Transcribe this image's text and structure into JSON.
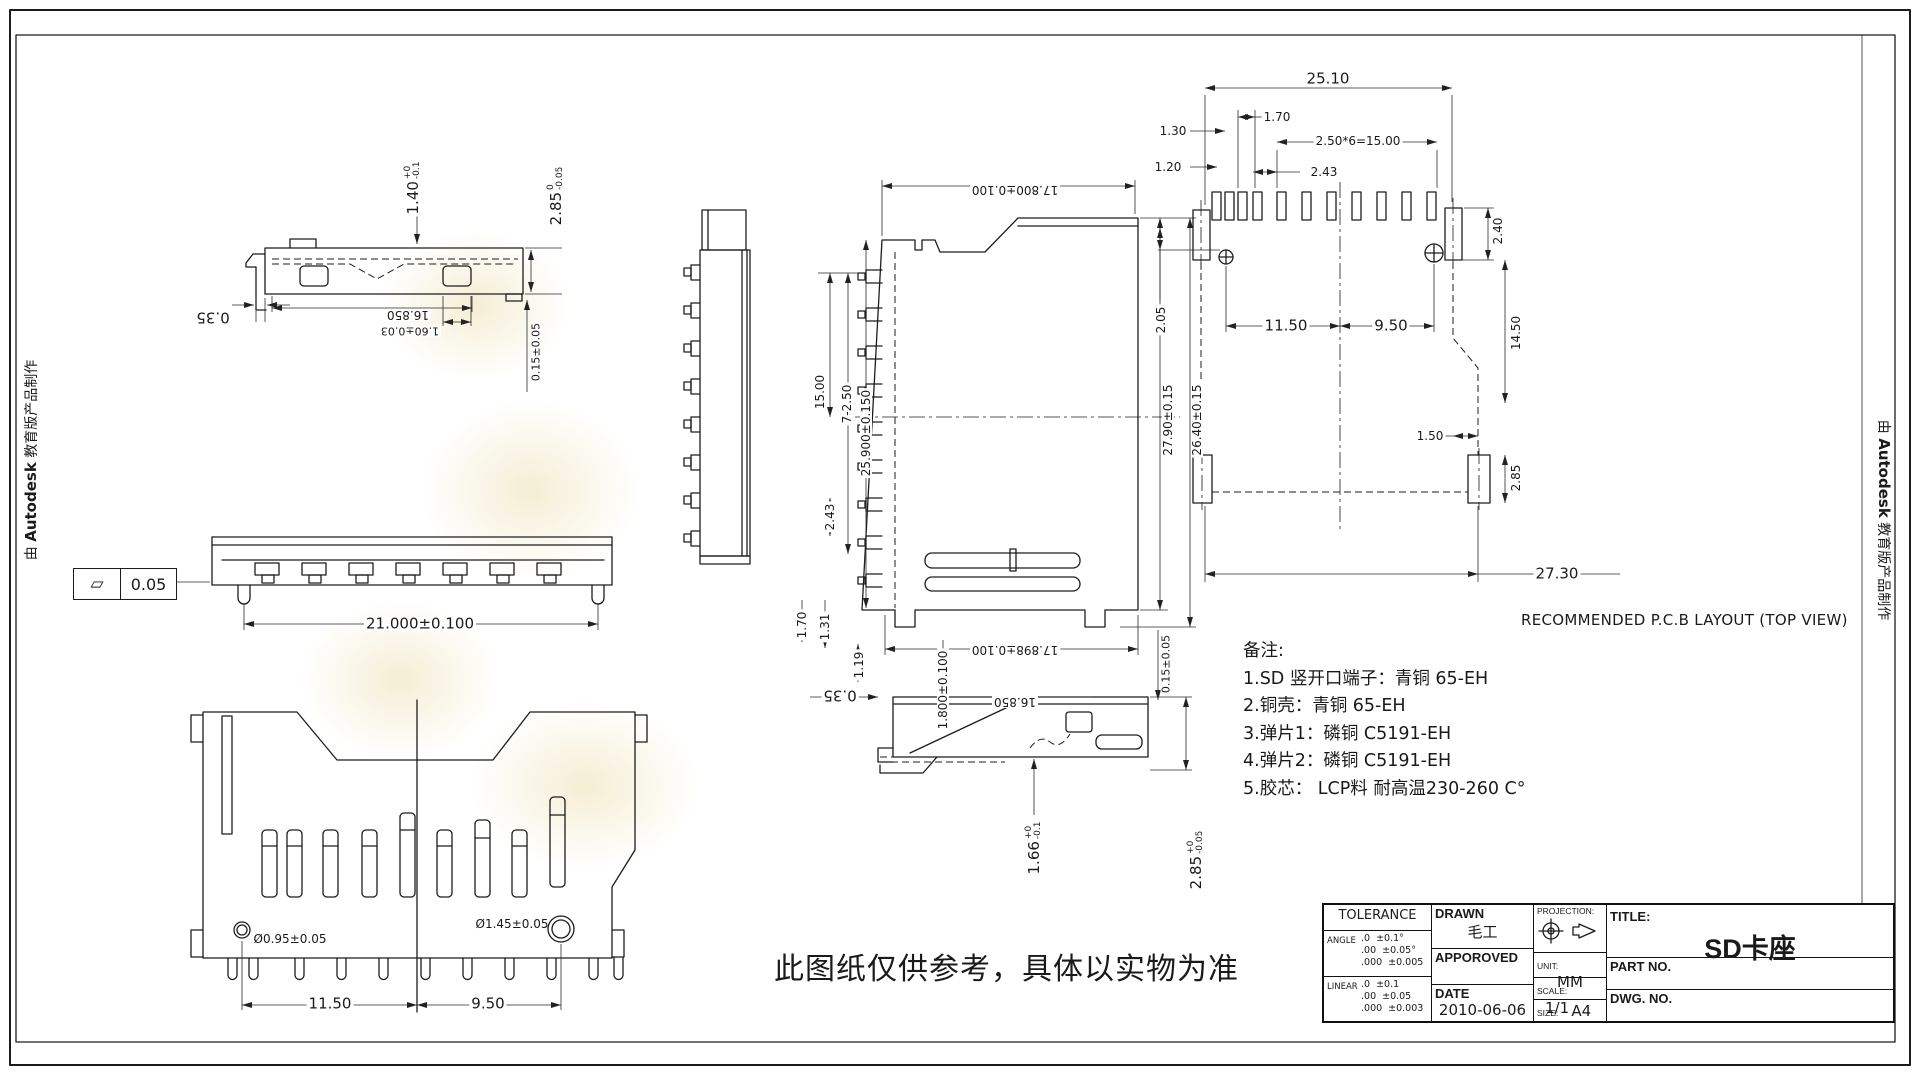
{
  "sheet": {
    "edge_note": {
      "prefix": "由",
      "brand": "Autodesk",
      "suffix": "教育版产品制作"
    },
    "disclaimer": "此图纸仅供参考，具体以实物为准"
  },
  "views": {
    "side_top": {
      "d140": {
        "m": "1.40",
        "u": "+0",
        "d": "-0.1"
      },
      "d285": {
        "m": "2.85",
        "u": "0",
        "d": "-0.05"
      },
      "d035": "0.35",
      "d16850": "16.850",
      "d160": "1.60±0.03",
      "d015": "0.15±0.05"
    },
    "front": {
      "flatness": "0.05",
      "d21000": "21.000±0.100"
    },
    "plan": {
      "hole_small": "Ø0.95±0.05",
      "hole_big": "Ø1.45±0.05",
      "d1150": "11.50",
      "d950": "9.50"
    },
    "main_top": {
      "d17800": "17.800±0.100",
      "d1500": "15.00",
      "d7250": "7-2.50",
      "d25900": "25.900±0.150",
      "d243": "2.43",
      "d170": "1.70",
      "d131": "1.31",
      "d119": "1.19",
      "d2790": "27.90±0.15",
      "d2640": "26.40±0.15",
      "d17898": "17.898±0.100"
    },
    "section": {
      "d035": "0.35",
      "d1800": "1.800±0.100",
      "d16850": "16.850",
      "d015": "0.15±0.05",
      "d166": {
        "m": "1.66",
        "u": "+0",
        "d": "-0.1"
      },
      "d285": {
        "m": "2.85",
        "u": "+0",
        "d": "-0.05"
      }
    },
    "pcb": {
      "title": "RECOMMENDED P.C.B LAYOUT (TOP VIEW)",
      "d2510": "25.10",
      "d130": "1.30",
      "d170": "1.70",
      "d120": "1.20",
      "d243": "2.43",
      "d250x6": "2.50*6=15.00",
      "d240": "2.40",
      "d205": "2.05",
      "d1150": "11.50",
      "d950": "9.50",
      "d1450": "14.50",
      "d150": "1.50",
      "d2730": "27.30",
      "d285": "2.85"
    }
  },
  "notes": {
    "title": "备注:",
    "items": [
      "1.SD 竖开口端子：青铜 65-EH",
      "2.铜壳：青铜 65-EH",
      "3.弹片1：磷铜 C5191-EH",
      "4.弹片2：磷铜 C5191-EH",
      "5.胶芯： LCP料 耐高温230-260 C°"
    ]
  },
  "title_block": {
    "tolerance": {
      "title": "TOLERANCE",
      "angle_label": "ANGLE",
      "linear_label": "LINEAR",
      "angle_rows": [
        {
          "p": ".0",
          "t": "±0.1°"
        },
        {
          "p": ".00",
          "t": "±0.05°"
        },
        {
          "p": ".000",
          "t": "±0.005"
        }
      ],
      "linear_rows": [
        {
          "p": ".0",
          "t": "±0.1"
        },
        {
          "p": ".00",
          "t": "±0.05"
        },
        {
          "p": ".000",
          "t": "±0.003"
        }
      ]
    },
    "drawn_label": "DRAWN",
    "drawn_value": "毛工",
    "approved_label": "APPOROVED",
    "date_label": "DATE",
    "date_value": "2010-06-06",
    "projection_label": "PROJECTION:",
    "unit_label": "UNIT:",
    "unit_value": "MM",
    "scale_label": "SCALE:",
    "scale_value": "1/1",
    "size_label": "SIZE:",
    "size_value": "A4",
    "title_label": "TITLE:",
    "title_value": "SD卡座",
    "part_no_label": "PART NO.",
    "dwg_no_label": "DWG. NO."
  }
}
